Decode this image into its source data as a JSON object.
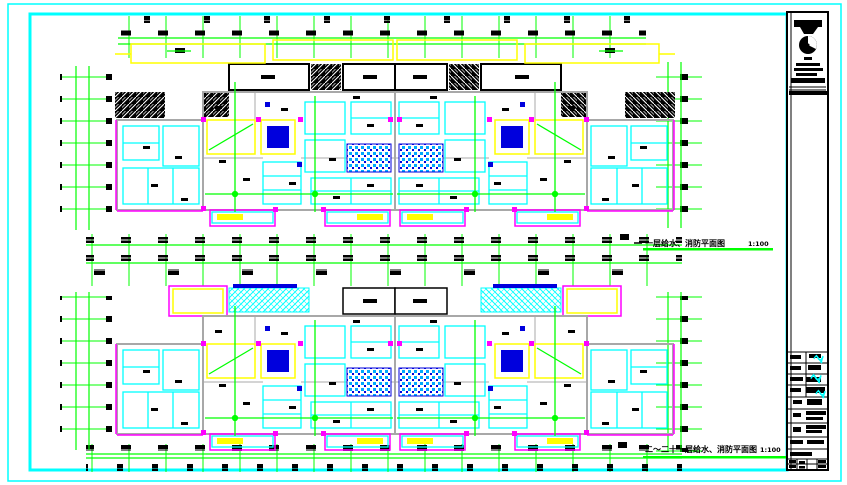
{
  "sheet": {
    "captions": {
      "upper": {
        "title": "一层给水、消防平面图",
        "scale": "1:100"
      },
      "lower": {
        "title": "二～二十一层给水、消防平面图",
        "scale": "1:100"
      }
    },
    "colors": {
      "frame_cyan": "#00ffff",
      "grid_green": "#00ff00",
      "wall_gray": "#a8a8a8",
      "room_cyan": "#00ffff",
      "accent_magenta": "#ff00ff",
      "highlight_yellow": "#ffff00",
      "fixture_blue": "#0000dd",
      "ink_black": "#000000",
      "paper_white": "#ffffff"
    },
    "icons": {
      "company_logo": "logo-circle-icon",
      "approval_stamp": "signature-stamp-icon"
    }
  }
}
